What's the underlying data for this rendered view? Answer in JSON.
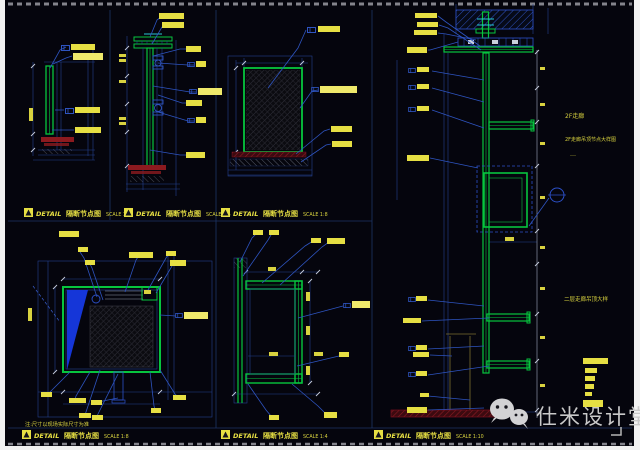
{
  "sheet": {
    "description": "CAD partition detail drawing sheet, dark model-space background"
  },
  "colors": {
    "background": "#05050d",
    "line_green": "#07c53e",
    "line_blue": "#2e54c0",
    "label_yellow": "#e6df43",
    "accent_red": "#8c1a1f",
    "accent_cyan": "#27c7d4",
    "sheet_white": "#f2f2f2",
    "watermark_gray": "#c9c9c9"
  },
  "title_blocks": [
    {
      "label": "DETAIL",
      "name": "隔断节点图",
      "scale": "SCALE 1:4"
    },
    {
      "label": "DETAIL",
      "name": "隔断节点图",
      "scale": "SCALE 1:5"
    },
    {
      "label": "DETAIL",
      "name": "隔断节点图",
      "scale": "SCALE 1:8"
    },
    {
      "label": "DETAIL",
      "name": "隔断节点图",
      "scale": "SCALE 1:8"
    },
    {
      "label": "DETAIL",
      "name": "隔断节点图",
      "scale": "SCALE 1:4"
    },
    {
      "label": "DETAIL",
      "name": "隔断节点图",
      "scale": "SCALE 1:10"
    }
  ],
  "annotations": {
    "note": "注:尺寸以现场实际尺寸为准",
    "loc_small": "2F走廊",
    "loc_long": "2F走廊吊顶节点大样图",
    "loc_mid": "二层走廊吊顶大样",
    "dots": "…"
  },
  "watermark": {
    "text": "仕米设计堂"
  }
}
